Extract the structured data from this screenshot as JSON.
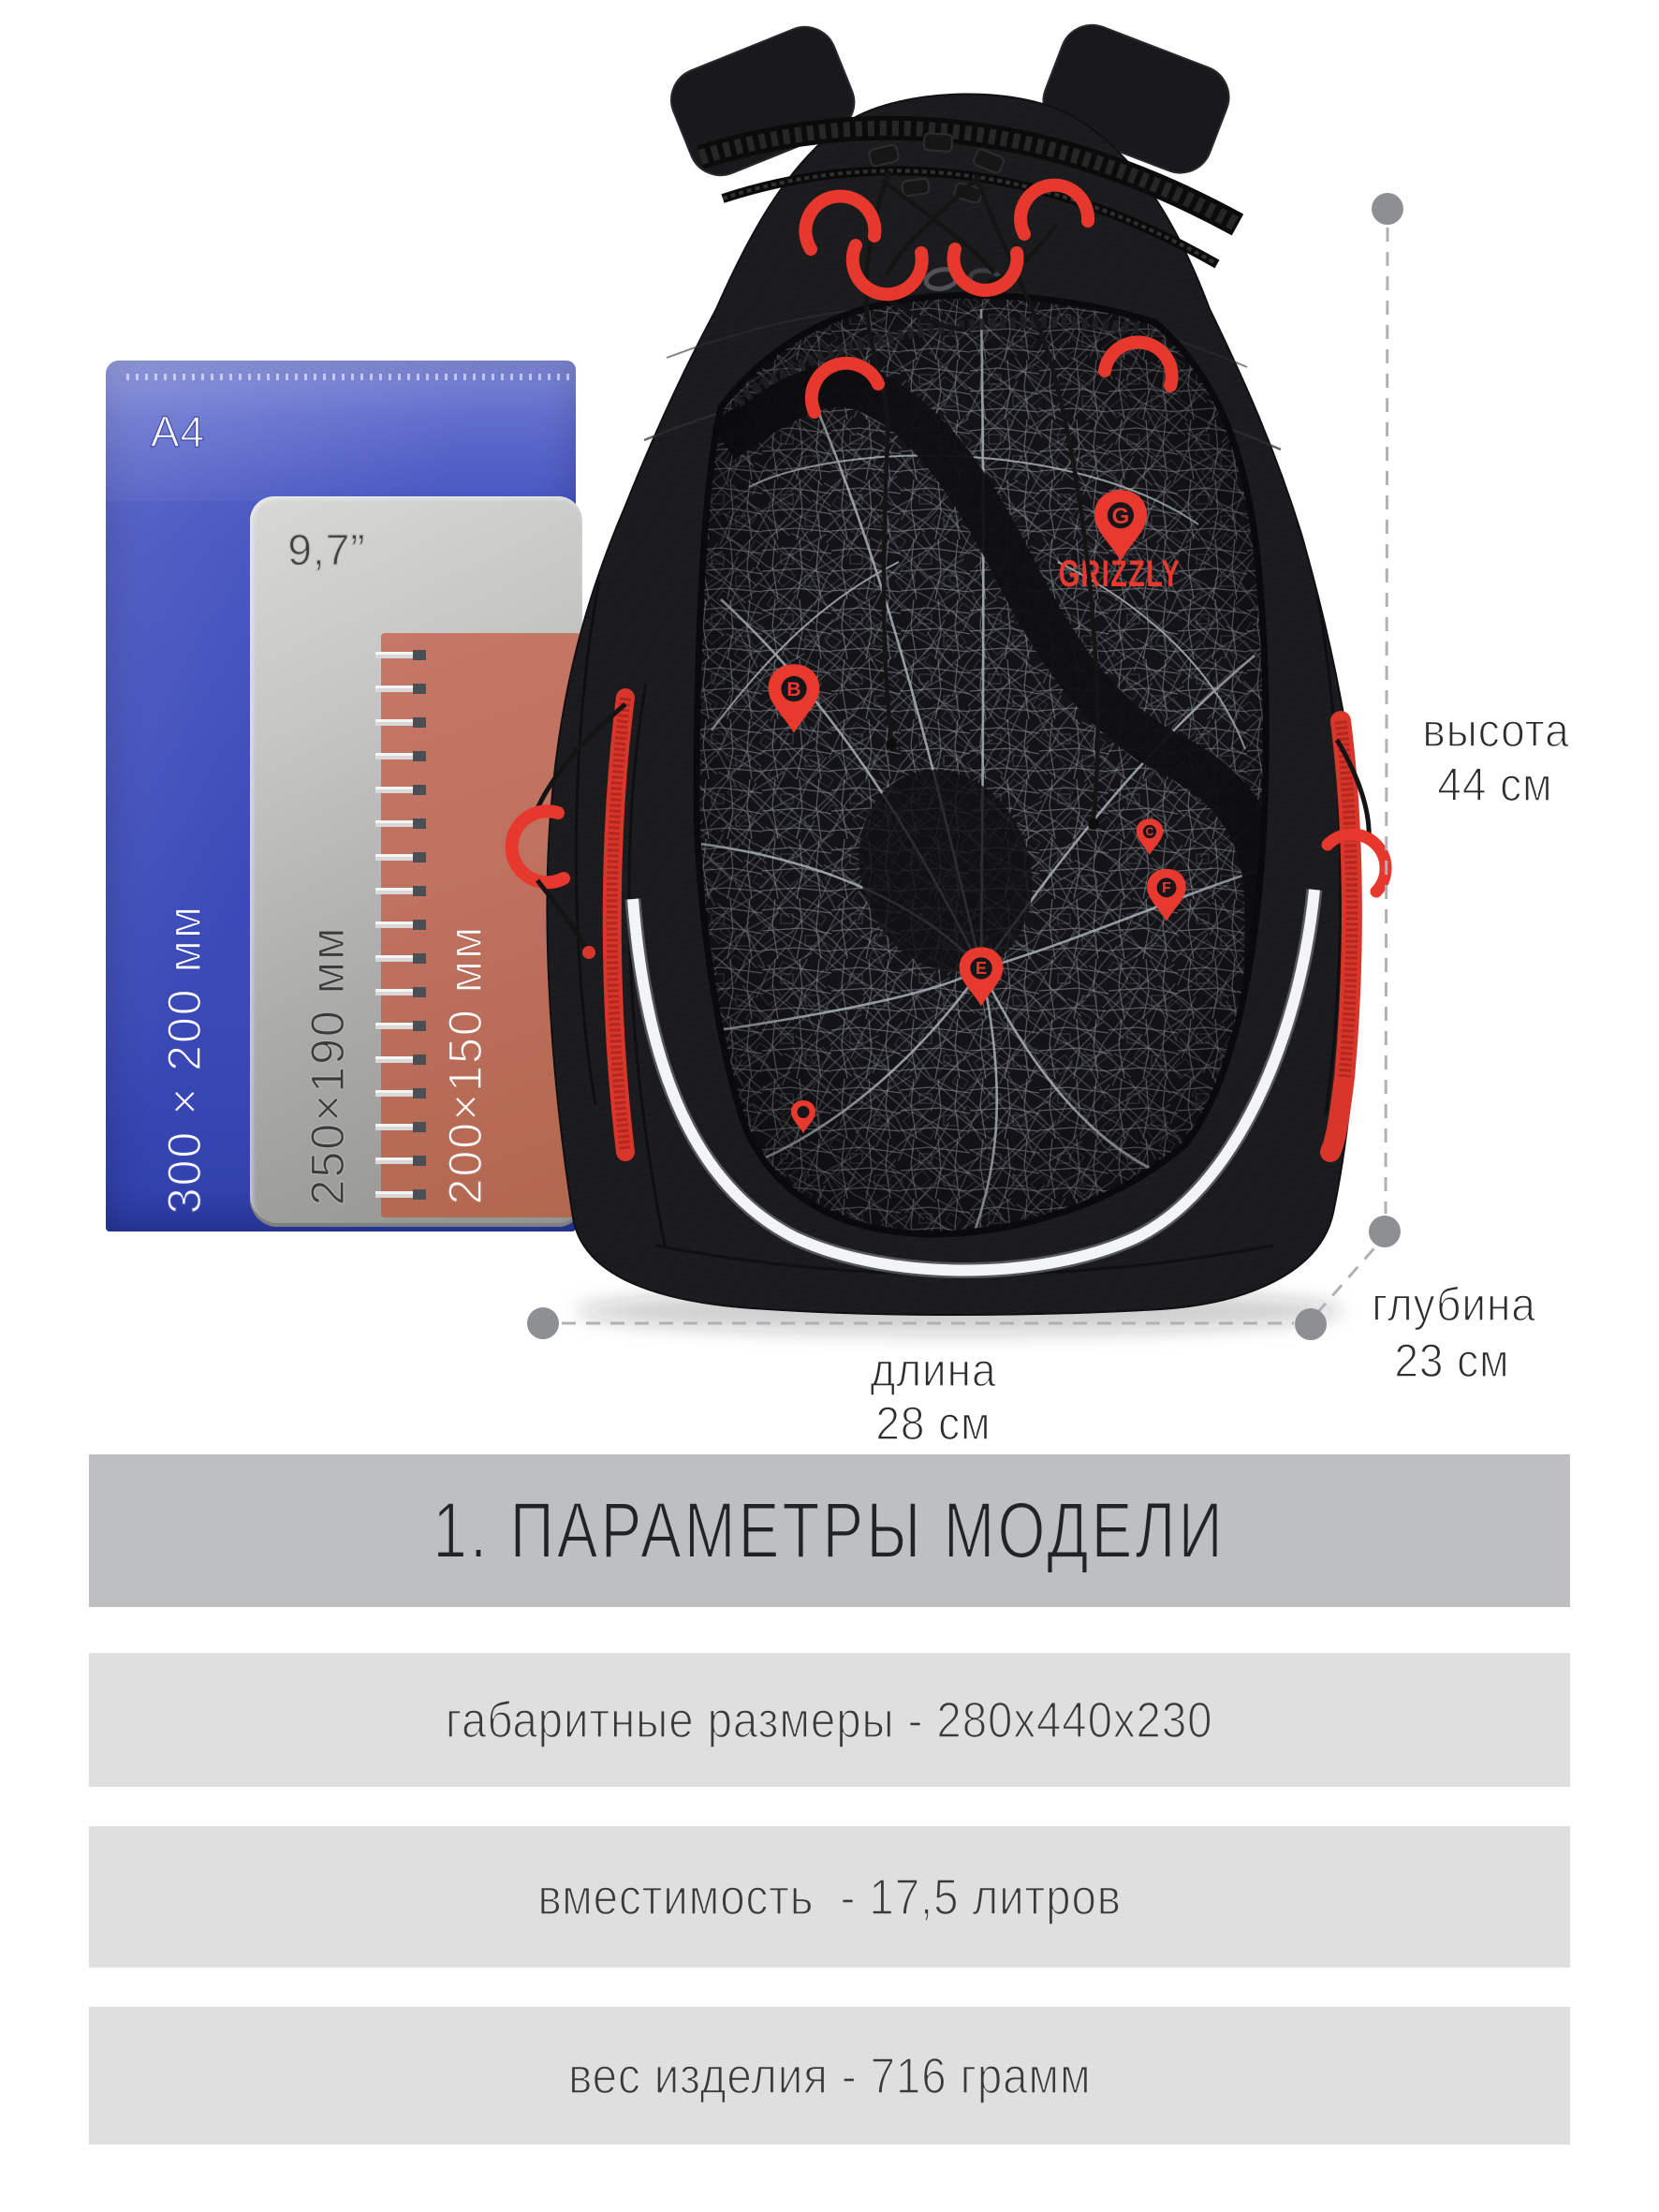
{
  "brand": {
    "wordmark": "GRIZZLY",
    "logo_pin_letter": "G"
  },
  "reference_items": {
    "folder_format": "A4",
    "folder_size": "300 × 200 мм",
    "tablet_screen": "9,7”",
    "tablet_size": "250×190 мм",
    "notebook_size": "200×150 мм"
  },
  "dimensions": {
    "height_label": "высота",
    "height_value": "44 см",
    "length_label": "длина",
    "length_value": "28 см",
    "depth_label": "глубина",
    "depth_value": "23 см"
  },
  "map_pins": {
    "pin_b": "B",
    "pin_c": "C",
    "pin_f": "F",
    "pin_e": "E"
  },
  "specs": {
    "title": "1. ПАРАМЕТРЫ МОДЕЛИ",
    "rows": [
      {
        "text": "габаритные размеры - 280х440х230"
      },
      {
        "text": "вместимость  - 17,5 литров"
      },
      {
        "text": "вес изделия - 716 грамм"
      }
    ]
  },
  "colors": {
    "accent_red": "#e6382c",
    "folder_blue": "#3e4ebc",
    "tablet_gray": "#b5b5b3",
    "notebook_coral": "#c0715e",
    "banner_header_bg": "#bdbfc1",
    "banner_row_bg": "#dfdfe0",
    "annotation_gray": "#8d9093",
    "backpack_black": "#1b1b1e",
    "map_line_gray": "#aab2b9"
  }
}
